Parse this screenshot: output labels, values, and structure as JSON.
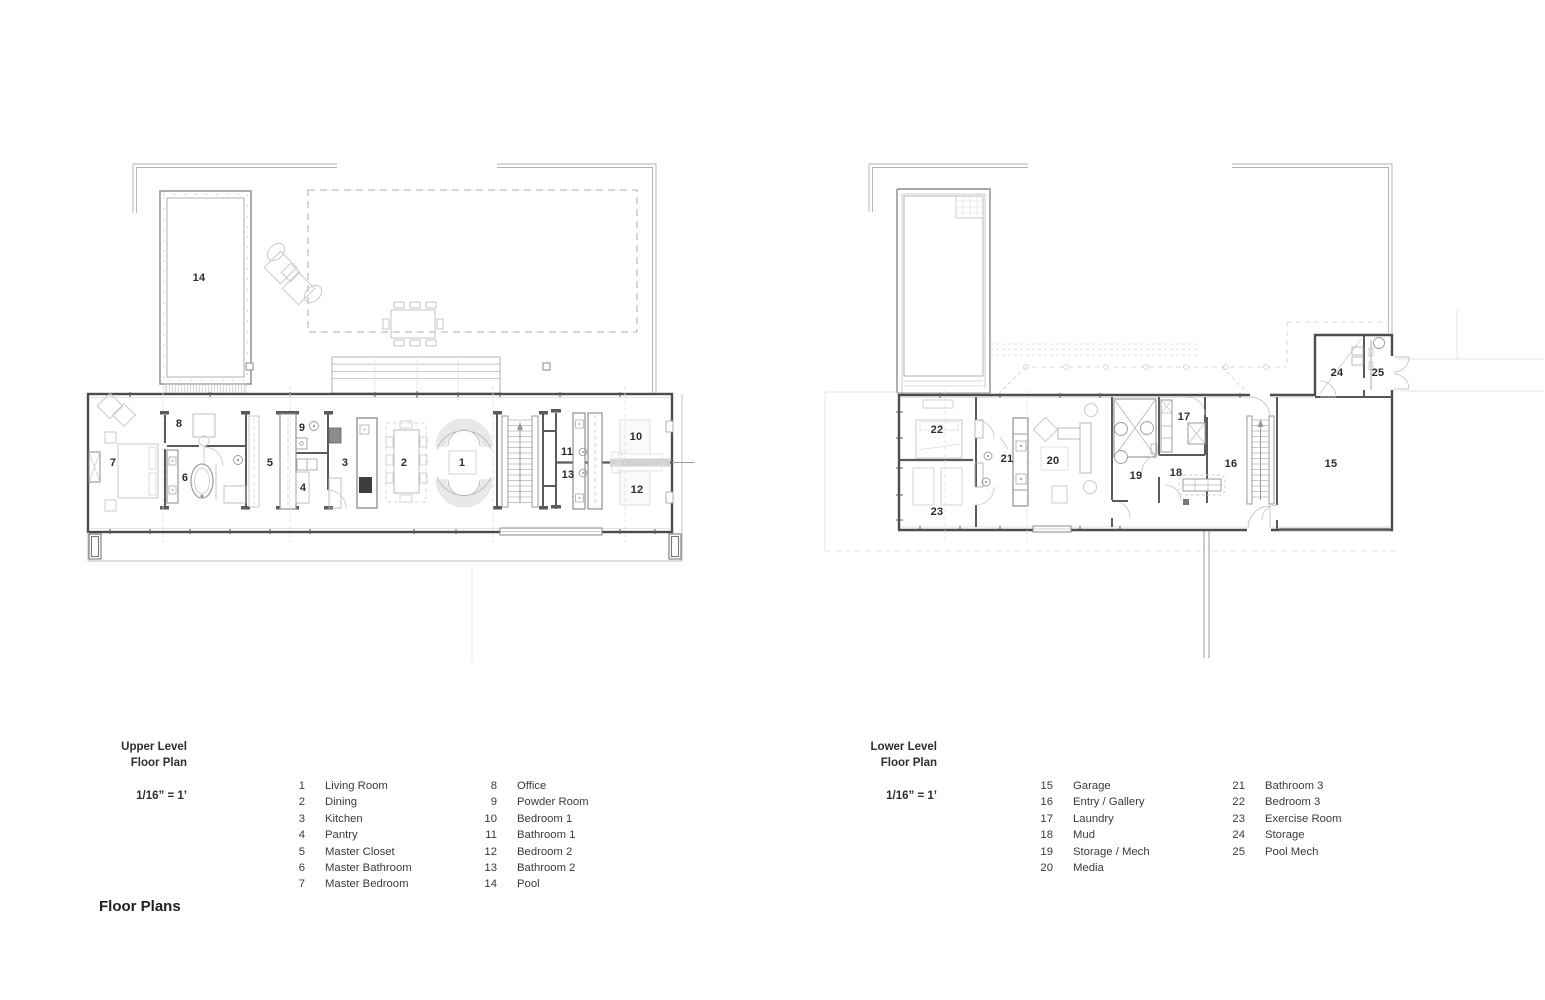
{
  "page": {
    "title": "Floor Plans"
  },
  "upper": {
    "title_line1": "Upper Level",
    "title_line2": "Floor Plan",
    "scale": "1/16” =  1’",
    "legend_col1": [
      {
        "num": "1",
        "label": "Living Room"
      },
      {
        "num": "2",
        "label": "Dining"
      },
      {
        "num": "3",
        "label": "Kitchen"
      },
      {
        "num": "4",
        "label": "Pantry"
      },
      {
        "num": "5",
        "label": "Master Closet"
      },
      {
        "num": "6",
        "label": "Master Bathroom"
      },
      {
        "num": "7",
        "label": "Master Bedroom"
      }
    ],
    "legend_col2": [
      {
        "num": "8",
        "label": "Office"
      },
      {
        "num": "9",
        "label": "Powder Room"
      },
      {
        "num": "10",
        "label": "Bedroom 1"
      },
      {
        "num": "11",
        "label": "Bathroom 1"
      },
      {
        "num": "12",
        "label": "Bedroom 2"
      },
      {
        "num": "13",
        "label": "Bathroom 2"
      },
      {
        "num": "14",
        "label": "Pool"
      }
    ],
    "labels": [
      "14",
      "7",
      "8",
      "6",
      "5",
      "9",
      "4",
      "3",
      "2",
      "1",
      "11",
      "13",
      "10",
      "12"
    ]
  },
  "lower": {
    "title_line1": "Lower Level",
    "title_line2": "Floor Plan",
    "scale": "1/16” =  1’",
    "legend_col1": [
      {
        "num": "15",
        "label": "Garage"
      },
      {
        "num": "16",
        "label": "Entry / Gallery"
      },
      {
        "num": "17",
        "label": "Laundry"
      },
      {
        "num": "18",
        "label": "Mud"
      },
      {
        "num": "19",
        "label": "Storage / Mech"
      },
      {
        "num": "20",
        "label": "Media"
      }
    ],
    "legend_col2": [
      {
        "num": "21",
        "label": "Bathroom 3"
      },
      {
        "num": "22",
        "label": "Bedroom 3"
      },
      {
        "num": "23",
        "label": "Exercise Room"
      },
      {
        "num": "24",
        "label": "Storage"
      },
      {
        "num": "25",
        "label": "Pool Mech"
      }
    ],
    "labels": [
      "22",
      "23",
      "21",
      "20",
      "19",
      "18",
      "17",
      "16",
      "15",
      "24",
      "25"
    ]
  }
}
